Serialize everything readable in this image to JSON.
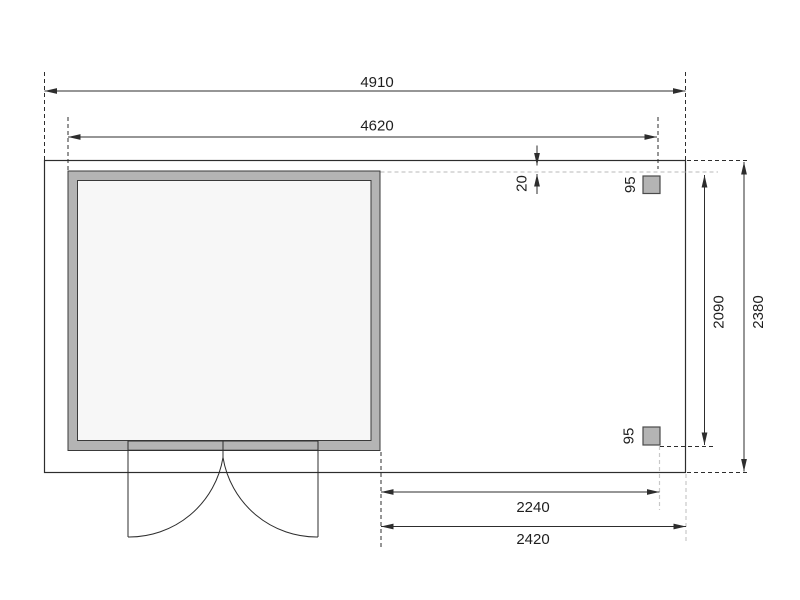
{
  "drawing": {
    "type": "shed-floor-plan-top-view",
    "dimensions": {
      "overall_width": "4910",
      "shed_outer_width": "4620",
      "roof_edge_gap": "20",
      "post_size_top": "95",
      "post_size_bottom": "95",
      "annex_post_span": "2240",
      "annex_overall_width": "2420",
      "annex_post_depth": "2090",
      "overall_depth": "2380"
    },
    "colors": {
      "line": "#2d2d2d",
      "floor_fill": "#f1f1f1",
      "wall_fill": "#b4b4b4",
      "interior_fill": "#f7f7f7",
      "post_fill": "#b4b4b4",
      "guide_dash_light": "#c8c8c8",
      "background": "#ffffff"
    }
  }
}
